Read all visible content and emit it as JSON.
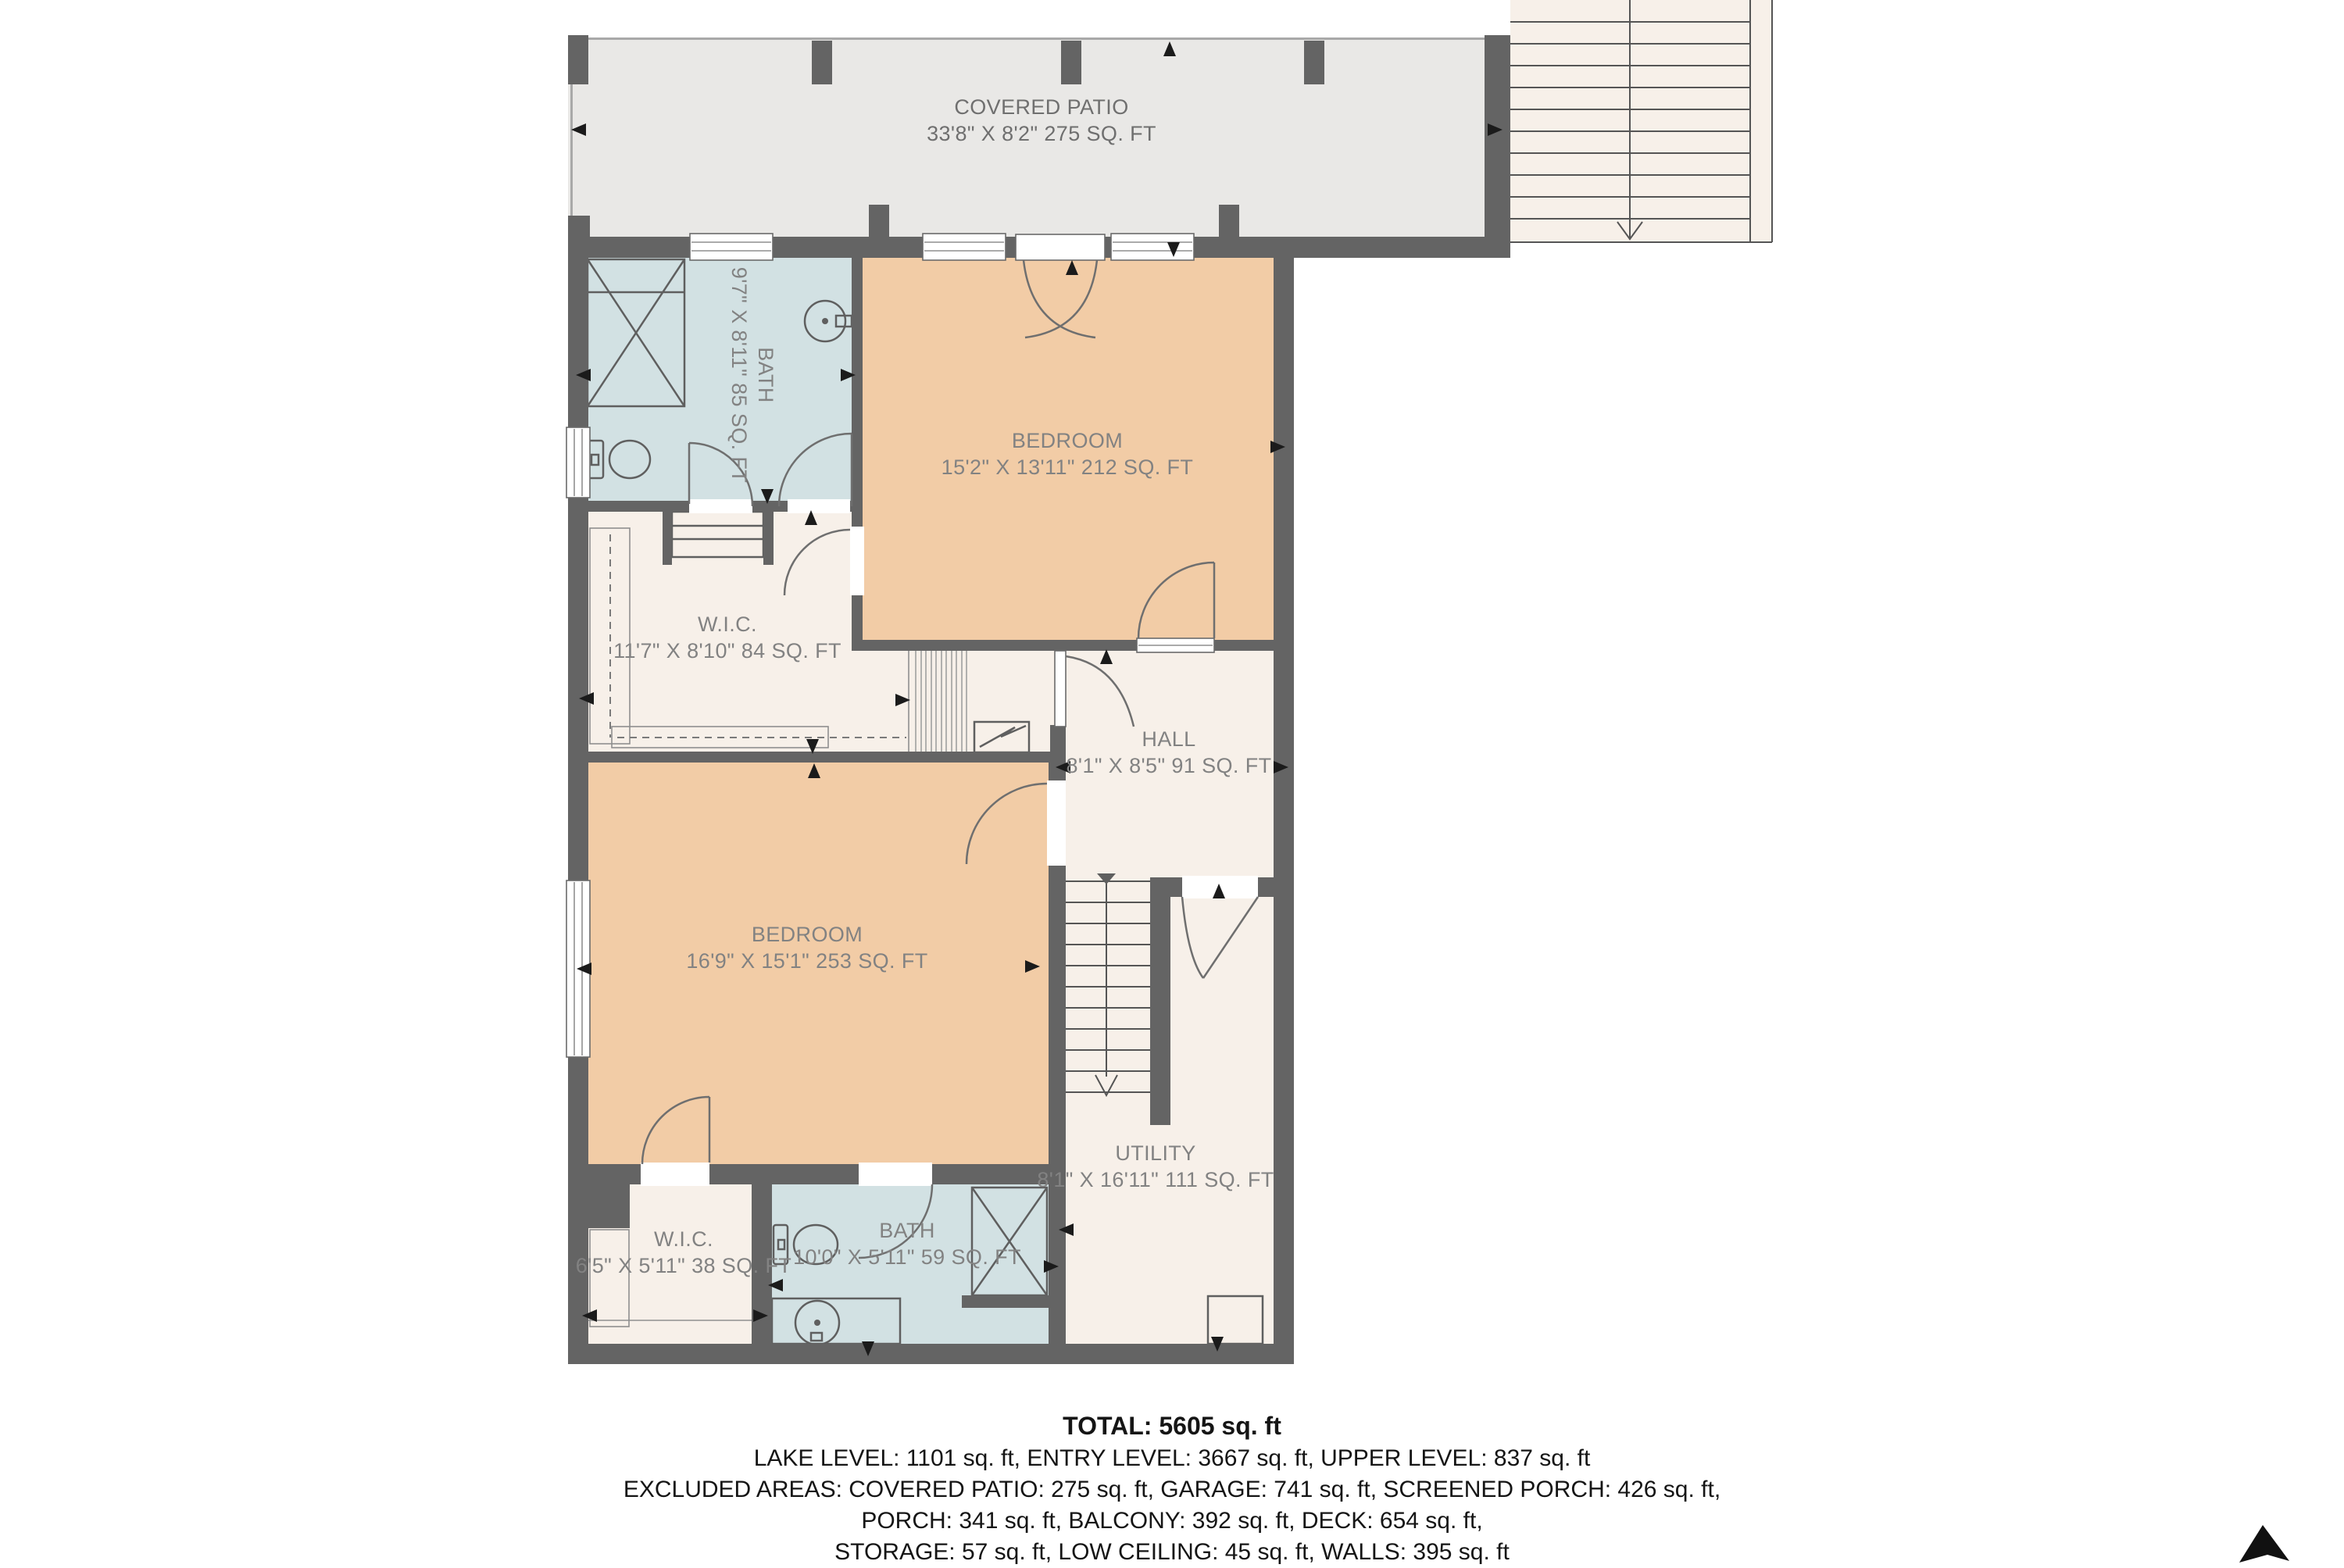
{
  "patio": {
    "name": "COVERED PATIO",
    "dims": "33'8\" X 8'2\" 275 SQ. FT"
  },
  "rooms": {
    "bath_upper": {
      "name": "BATH",
      "dims": "9'7\" X 8'11\" 85 SQ. FT"
    },
    "bedroom_upper": {
      "name": "BEDROOM",
      "dims": "15'2\" X 13'11\" 212 SQ. FT"
    },
    "wic_upper": {
      "name": "W.I.C.",
      "dims": "11'7\" X 8'10\" 84 SQ. FT"
    },
    "hall": {
      "name": "HALL",
      "dims": "8'1\" X 8'5\" 91 SQ. FT"
    },
    "bedroom_lower": {
      "name": "BEDROOM",
      "dims": "16'9\" X 15'1\" 253 SQ. FT"
    },
    "utility": {
      "name": "UTILITY",
      "dims": "8'1\" X 16'11\" 111 SQ. FT"
    },
    "wic_lower": {
      "name": "W.I.C.",
      "dims": "6'5\" X 5'11\" 38 SQ. FT"
    },
    "bath_lower": {
      "name": "BATH",
      "dims": "10'0\" X 5'11\" 59 SQ. FT"
    }
  },
  "summary": {
    "total": "TOTAL: 5605 sq. ft",
    "levels": "LAKE LEVEL: 1101 sq. ft, ENTRY LEVEL: 3667 sq. ft, UPPER LEVEL: 837 sq. ft",
    "excluded_1": "EXCLUDED AREAS: COVERED PATIO: 275 sq. ft, GARAGE: 741 sq. ft, SCREENED PORCH: 426 sq. ft,",
    "excluded_2": "PORCH: 341 sq. ft, BALCONY: 392 sq. ft, DECK: 654 sq. ft,",
    "excluded_3": "STORAGE: 57 sq. ft, LOW CEILING: 45 sq. ft, WALLS: 395 sq. ft"
  },
  "colors": {
    "wall": "#646464",
    "bath": "#d2e1e3",
    "bedroom": "#f2cca6",
    "cream": "#f7f0e9",
    "patio": "#e9e8e6",
    "room_text": "#828282"
  }
}
